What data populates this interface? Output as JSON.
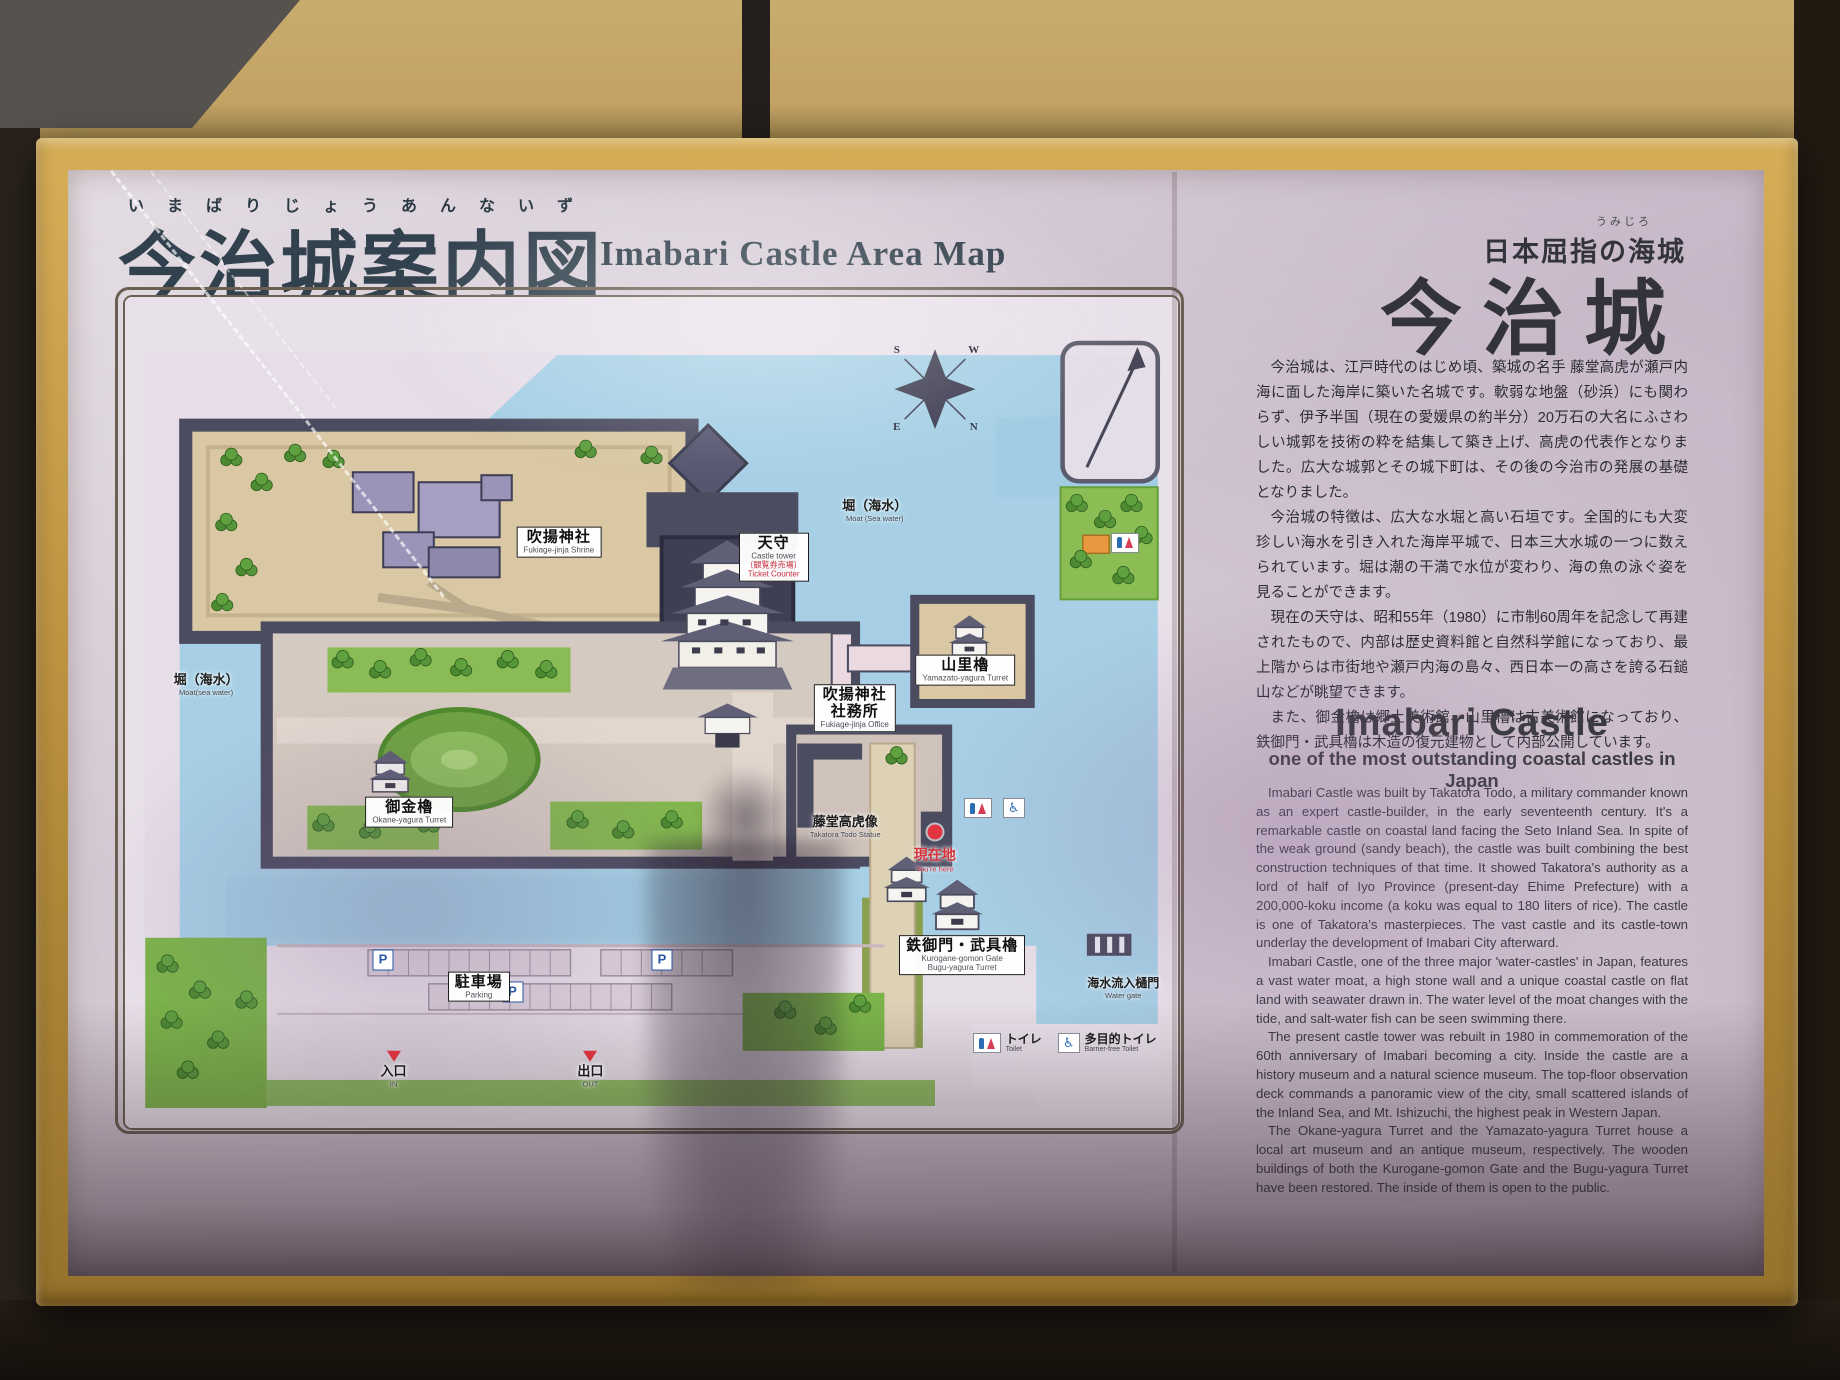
{
  "header": {
    "title_furigana": "いまばりじょうあんないず",
    "title_jp": "今治城案内図",
    "title_en": "Imabari Castle Area Map",
    "tagline_furigana": "うみじろ",
    "tagline_jp": "日本屈指の海城",
    "castle_name_jp": "今治城"
  },
  "description_jp": {
    "paragraphs": [
      "今治城は、江戸時代のはじめ頃、築城の名手 藤堂高虎が瀬戸内海に面した海岸に築いた名城です。軟弱な地盤（砂浜）にも関わらず、伊予半国（現在の愛媛県の約半分）20万石の大名にふさわしい城郭を技術の粋を結集して築き上げ、高虎の代表作となりました。広大な城郭とその城下町は、その後の今治市の発展の基礎となりました。",
      "今治城の特徴は、広大な水堀と高い石垣です。全国的にも大変珍しい海水を引き入れた海岸平城で、日本三大水城の一つに数えられています。堀は潮の干満で水位が変わり、海の魚の泳ぐ姿を見ることができます。",
      "現在の天守は、昭和55年（1980）に市制60周年を記念して再建されたもので、内部は歴史資料館と自然科学館になっており、最上階からは市街地や瀬戸内海の島々、西日本一の高さを誇る石鎚山などが眺望できます。",
      "また、御金櫓は郷土美術館、山里櫓は古美術館になっており、鉄御門・武具櫓は木造の復元建物として内部公開しています。"
    ]
  },
  "description_en": {
    "heading": "Imabari Castle",
    "subheading": "one of the most outstanding coastal castles in Japan",
    "paragraphs": [
      "Imabari Castle was built by Takatora Todo, a military commander known as an expert castle-builder, in the early seventeenth century. It's a remarkable castle on coastal land facing the Seto Inland Sea. In spite of the weak ground (sandy beach), the castle was built combining the best construction techniques of that time. It showed Takatora's authority as a lord of half of Iyo Province (present-day Ehime Prefecture) with a 200,000-koku income (a koku was equal to 180 liters of rice). The castle is one of Takatora's masterpieces. The vast castle and its castle-town underlay the development of Imabari City afterward.",
      "Imabari Castle, one of the three major 'water-castles' in Japan, features a vast water moat, a high stone wall and a unique coastal castle on flat land with seawater drawn in. The water level of the moat changes with the tide, and salt-water fish can be seen swimming there.",
      "The present castle tower was rebuilt in 1980 in commemoration of the 60th anniversary of Imabari becoming a city. Inside the castle are a history museum and a natural science museum. The top-floor observation deck commands a panoramic view of the city, small scattered islands of the Inland Sea, and Mt. Ishizuchi, the highest peak in Western Japan.",
      "The Okane-yagura Turret and the Yamazato-yagura Turret house a local art museum and an antique museum, respectively. The wooden buildings of both the Kurogane-gomon Gate and the Bugu-yagura Turret have been restored. The inside of them is open to the public."
    ]
  },
  "map": {
    "boxed_labels": [
      {
        "jp": "吹揚神社",
        "en": "Fukiage-jinja Shrine"
      },
      {
        "jp": "天守",
        "en": "Castle tower",
        "jp_note": "〔観覧券売場〕",
        "en_note": "Ticket Counter"
      },
      {
        "jp": "吹揚神社",
        "jp2": "社務所",
        "en": "Fukiage-jinja Office"
      },
      {
        "jp": "山里櫓",
        "en": "Yamazato-yagura Turret"
      },
      {
        "jp": "御金櫓",
        "en": "Okane-yagura Turret"
      },
      {
        "jp": "鉄御門・武具櫓",
        "en": "Kurogane-gomon Gate",
        "en2": "Bugu-yagura Turret"
      },
      {
        "jp": "駐車場",
        "en": "Parking"
      }
    ],
    "plain_labels": [
      {
        "jp": "堀（海水）",
        "en": "Moat (Sea water)"
      },
      {
        "jp": "堀（海水）",
        "en": "Moat(sea water)"
      },
      {
        "jp": "藤堂高虎像",
        "en": "Takatora Todo Statue"
      },
      {
        "jp": "現在地",
        "en": "You're here"
      },
      {
        "jp": "海水流入樋門",
        "en": "Water gate"
      },
      {
        "jp": "入口",
        "en": "IN"
      },
      {
        "jp": "出口",
        "en": "OUT"
      }
    ],
    "legend": [
      {
        "jp": "トイレ",
        "en": "Toilet"
      },
      {
        "jp": "多目的トイレ",
        "en": "Barrier-free Toilet"
      }
    ],
    "compass": {
      "n": "N",
      "s": "S",
      "e": "E",
      "w": "W"
    },
    "parking_badge": "P",
    "icons": {
      "barrier_free_glyph": "♿"
    }
  }
}
